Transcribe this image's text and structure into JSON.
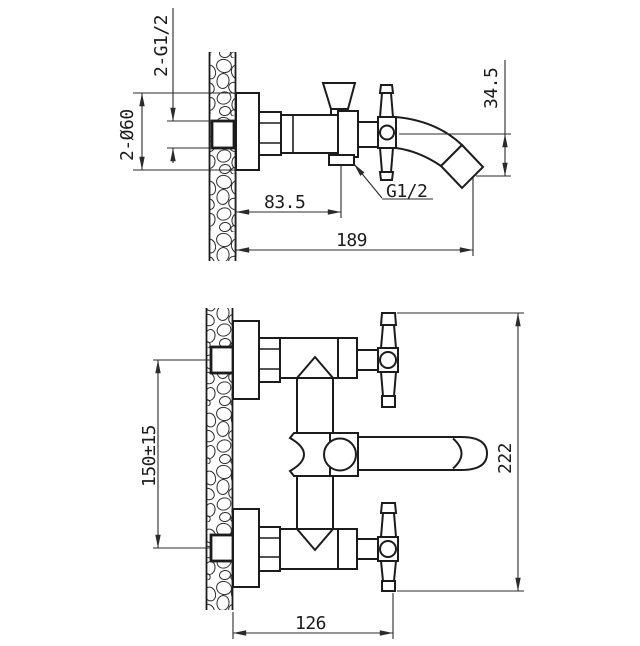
{
  "labels": {
    "side_view": {
      "inlet_thread": "2-G1/2",
      "escutcheon_diameter": "2-Ø60",
      "spout_drop": "34.5",
      "shower_outlet_offset": "83.5",
      "shower_outlet_thread": "G1/2",
      "total_reach": "189"
    },
    "front_view": {
      "inlet_spacing": "150±15",
      "overall_height": "222",
      "overall_depth": "126"
    }
  },
  "colors": {
    "background": "#ffffff",
    "object_line": "#1c1c1c",
    "dimension_line": "#2b2b2b",
    "text": "#1c1c1c"
  }
}
